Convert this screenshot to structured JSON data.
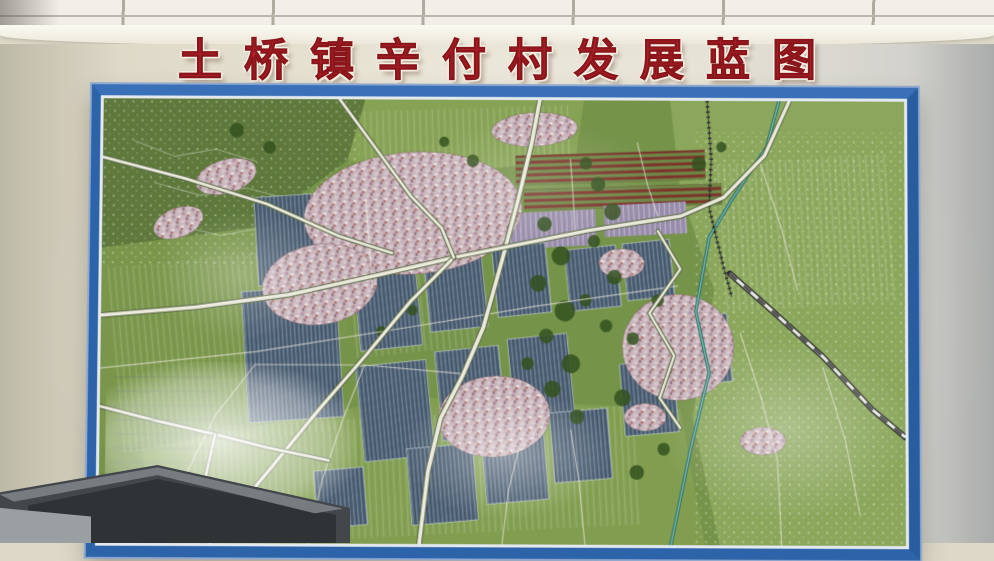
{
  "title": {
    "text": "土桥镇辛付村发展蓝图"
  },
  "colors": {
    "title_red": "#b0212a",
    "frame_blue": "#2d63a9",
    "frame_inner_white": "#e3e9ef",
    "wall_cream": "#eae6d7",
    "ceiling_white": "#f1efe7",
    "map_base_green": "#76934a",
    "greenhouse_slate": "#46586c",
    "village_pink": "#c9b6bd",
    "orchard_red": "#7c3128",
    "river_teal": "#2f7168",
    "road_white": "#eceadd"
  },
  "map": {
    "regions": [
      {
        "name": "forest-northwest",
        "points": "0,0 255,0 238,58 150,122 42,162 0,142",
        "fill": "#5e793b"
      },
      {
        "name": "fields-north",
        "points": "255,0 468,0 460,56 300,74 238,58",
        "fill": "#86a254"
      },
      {
        "name": "plain-east",
        "points": "552,0 780,0 780,420 600,420 574,300 595,180 562,86",
        "fill": "#8ba75c"
      },
      {
        "name": "farmland-west",
        "points": "0,142 150,122 232,152 240,222 150,302 0,332",
        "fill": "#79964a"
      },
      {
        "name": "fields-south",
        "points": "40,332 300,282 562,292 586,420 60,420",
        "fill": "#819e50"
      }
    ],
    "field_overlays": [
      {
        "x": 14,
        "y": 150,
        "w": 210,
        "h": 175,
        "rot": -6
      },
      {
        "x": 250,
        "y": 8,
        "w": 205,
        "h": 58,
        "rot": -2
      },
      {
        "x": 598,
        "y": 55,
        "w": 170,
        "h": 140,
        "rot": -4
      },
      {
        "x": 90,
        "y": 300,
        "w": 430,
        "h": 112,
        "rot": -3
      },
      {
        "x": 240,
        "y": 120,
        "w": 120,
        "h": 120,
        "rot": -6
      }
    ],
    "speckle_overlays": [
      {
        "x": 575,
        "y": 30,
        "w": 205,
        "h": 390,
        "rot": 0
      },
      {
        "x": 0,
        "y": 0,
        "w": 250,
        "h": 160,
        "rot": 0
      }
    ],
    "red_blocks": [
      {
        "x": 402,
        "y": 50,
        "w": 184,
        "h": 28,
        "rot": -2
      },
      {
        "x": 410,
        "y": 82,
        "w": 192,
        "h": 20,
        "rot": -2
      }
    ],
    "lavender_blocks": [
      {
        "x": 386,
        "y": 106,
        "w": 94,
        "h": 34,
        "rot": -3
      },
      {
        "x": 488,
        "y": 98,
        "w": 80,
        "h": 30,
        "rot": -3
      },
      {
        "x": 300,
        "y": 88,
        "w": 60,
        "h": 26,
        "rot": -4
      }
    ],
    "greenhouses": [
      {
        "x": 140,
        "y": 180,
        "w": 92,
        "h": 124,
        "rot": -4
      },
      {
        "x": 150,
        "y": 92,
        "w": 56,
        "h": 84,
        "rot": -4
      },
      {
        "x": 248,
        "y": 156,
        "w": 60,
        "h": 80,
        "rot": -6
      },
      {
        "x": 316,
        "y": 146,
        "w": 56,
        "h": 72,
        "rot": -6
      },
      {
        "x": 382,
        "y": 138,
        "w": 52,
        "h": 66,
        "rot": -6
      },
      {
        "x": 252,
        "y": 250,
        "w": 68,
        "h": 90,
        "rot": -6
      },
      {
        "x": 328,
        "y": 236,
        "w": 62,
        "h": 84,
        "rot": -6
      },
      {
        "x": 398,
        "y": 224,
        "w": 58,
        "h": 76,
        "rot": -6
      },
      {
        "x": 300,
        "y": 328,
        "w": 64,
        "h": 72,
        "rot": -5
      },
      {
        "x": 372,
        "y": 310,
        "w": 60,
        "h": 70,
        "rot": -5
      },
      {
        "x": 438,
        "y": 294,
        "w": 56,
        "h": 66,
        "rot": -5
      },
      {
        "x": 452,
        "y": 140,
        "w": 50,
        "h": 58,
        "rot": -6
      },
      {
        "x": 508,
        "y": 134,
        "w": 46,
        "h": 54,
        "rot": -6
      },
      {
        "x": 560,
        "y": 204,
        "w": 50,
        "h": 64,
        "rot": -5
      },
      {
        "x": 506,
        "y": 248,
        "w": 52,
        "h": 68,
        "rot": -5
      },
      {
        "x": 210,
        "y": 350,
        "w": 48,
        "h": 54,
        "rot": -5
      }
    ],
    "villages": [
      {
        "cx": 302,
        "cy": 108,
        "rx": 106,
        "ry": 58,
        "rot": -4
      },
      {
        "cx": 212,
        "cy": 176,
        "rx": 56,
        "ry": 38,
        "rot": -8
      },
      {
        "cx": 560,
        "cy": 234,
        "rx": 54,
        "ry": 50,
        "rot": 0
      },
      {
        "cx": 382,
        "cy": 300,
        "rx": 54,
        "ry": 38,
        "rot": -4
      },
      {
        "cx": 120,
        "cy": 74,
        "rx": 30,
        "ry": 16,
        "rot": -16
      },
      {
        "cx": 74,
        "cy": 118,
        "rx": 25,
        "ry": 14,
        "rot": -20
      },
      {
        "cx": 420,
        "cy": 28,
        "rx": 42,
        "ry": 16,
        "rot": -3
      },
      {
        "cx": 642,
        "cy": 322,
        "rx": 22,
        "ry": 13,
        "rot": 0
      },
      {
        "cx": 505,
        "cy": 155,
        "rx": 22,
        "ry": 14,
        "rot": 0
      },
      {
        "cx": 528,
        "cy": 300,
        "rx": 20,
        "ry": 13,
        "rot": 0
      }
    ],
    "trees": [
      [
        430,
        118,
        7
      ],
      [
        446,
        148,
        9
      ],
      [
        424,
        174,
        8
      ],
      [
        450,
        200,
        10
      ],
      [
        432,
        224,
        7
      ],
      [
        456,
        250,
        9
      ],
      [
        438,
        274,
        8
      ],
      [
        462,
        300,
        7
      ],
      [
        470,
        190,
        6
      ],
      [
        414,
        250,
        6
      ],
      [
        478,
        134,
        6
      ],
      [
        498,
        168,
        7
      ],
      [
        490,
        214,
        6
      ],
      [
        506,
        282,
        8
      ],
      [
        360,
        58,
        6
      ],
      [
        332,
        40,
        5
      ],
      [
        130,
        30,
        7
      ],
      [
        162,
        46,
        6
      ],
      [
        580,
        60,
        7
      ],
      [
        602,
        44,
        5
      ],
      [
        546,
        330,
        6
      ],
      [
        520,
        352,
        7
      ],
      [
        302,
        200,
        5
      ],
      [
        272,
        220,
        5
      ],
      [
        482,
        80,
        7
      ],
      [
        496,
        106,
        8
      ],
      [
        470,
        60,
        6
      ],
      [
        516,
        226,
        6
      ],
      [
        540,
        190,
        6
      ]
    ],
    "contours": [
      "30,40 70,55 110,48 150,60",
      "50,80 95,92 140,85 180,95",
      "70,120 115,130 160,122"
    ],
    "river": "658,0 646,44 612,94 590,130 577,200 590,258 572,330 553,420",
    "railway": "588,0 592,56 590,102 604,158 612,186",
    "roads_major": [
      {
        "p": "425,0 417,42 404,96 389,152 371,216 351,262 330,302 318,352 310,420",
        "w": 3.6
      },
      {
        "p": "0,206 92,198 182,186 272,166 342,150",
        "w": 3.4
      },
      {
        "p": "342,150 422,134 472,124 522,116 562,110 604,92 644,52 668,0",
        "w": 3.2
      },
      {
        "p": "342,150 300,192 258,242 214,292 164,352 130,392 108,420",
        "w": 3.0
      },
      {
        "p": "0,292 58,306 112,318 162,330 222,342",
        "w": 2.6
      },
      {
        "p": "112,318 100,372 96,420",
        "w": 2.4
      },
      {
        "p": "230,0 262,42 300,92 330,122 342,150",
        "w": 2.6
      },
      {
        "p": "0,56 80,76 160,100 230,130 282,146",
        "w": 2.6
      },
      {
        "p": "540,124 562,160 532,202 556,242 542,282 562,310",
        "w": 2.2
      }
    ],
    "highway": "610,164 652,200 700,242 748,292 780,318",
    "roads_minor": [
      "0,256 150,240 300,216 420,196 560,176",
      "62,420 82,360 112,300 150,252",
      "202,420 216,360 236,302 256,252",
      "390,420 396,370 406,330",
      "470,420 464,360 456,312",
      "256,96 260,140 263,180",
      "455,56 458,96 460,130",
      "620,220 640,280 656,340 660,420",
      "700,252 722,322 736,392",
      "640,60 660,120 676,180",
      "520,40 530,80 540,110",
      "150,252 256,252 352,260"
    ]
  }
}
